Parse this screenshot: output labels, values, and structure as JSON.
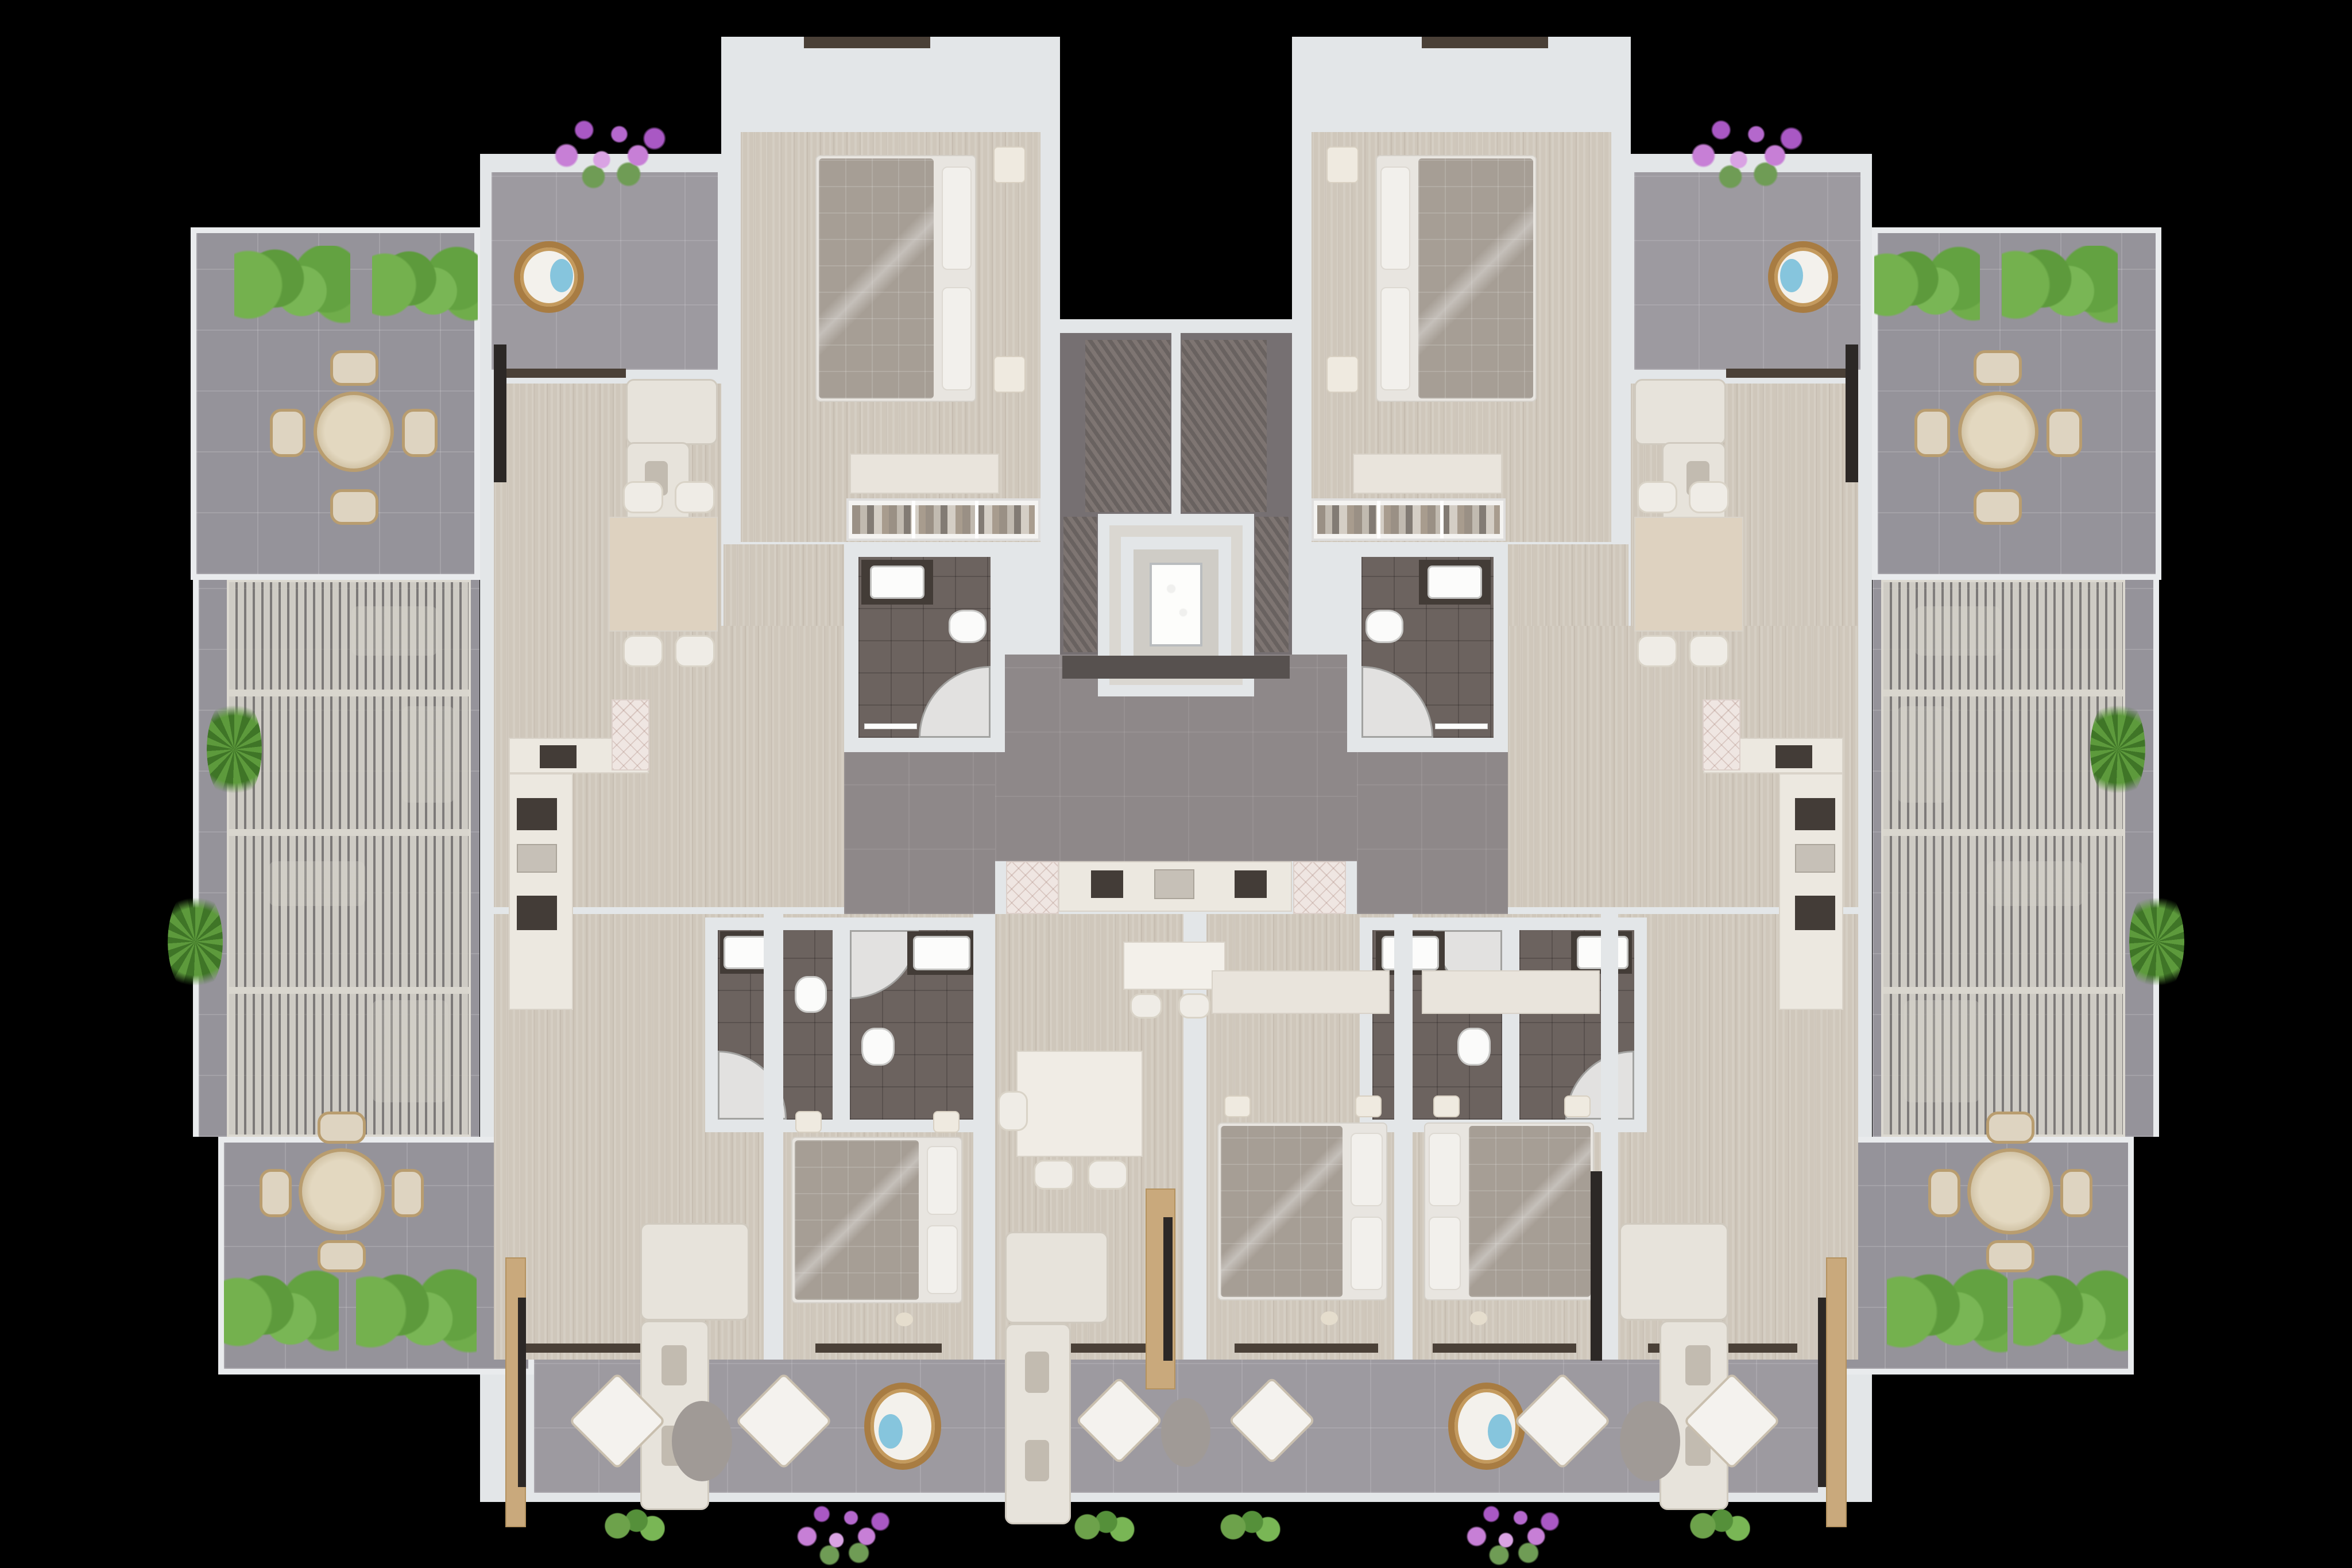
{
  "scene": {
    "ariaLabel": "Top-down 3D architectural floor plan rendering of a symmetric apartment building floor on a black background",
    "type": "residential-floor-plan-render",
    "visible_text": []
  },
  "colors": {
    "background": "#000000",
    "wall": "#e3e6e8",
    "wood": "#cfc7bb",
    "terrace": "#95939a",
    "balcony": "#9d9aa0",
    "hallway": "#8e8889",
    "bathroom": "#6c635f",
    "core": "#767072",
    "sill": "#4a4037",
    "pergola_slat": "#d1cec6",
    "hedge_green": "#63a241",
    "flower_purple": "#c77fd6",
    "sofa_cream": "#e7e3db",
    "bed_blanket": "#a69e95",
    "rattan": "#a87c42",
    "accent_blue": "#86c5dd",
    "counter": "#ece8e0",
    "table_wood": "#d3c5a8"
  },
  "inventory": {
    "elevator": 1,
    "stair_flights": 2,
    "bedrooms": 6,
    "bathrooms": 6,
    "living_rooms": 5,
    "kitchens": 3,
    "round_terrace_tables": 4,
    "dining_tables": 3,
    "egg_chairs": 4,
    "diamond_armchair_sets": 3,
    "pergolas": 2,
    "terraces": 6,
    "hedge_clusters": 8,
    "flower_clusters": 4,
    "wardrobes": 2
  }
}
